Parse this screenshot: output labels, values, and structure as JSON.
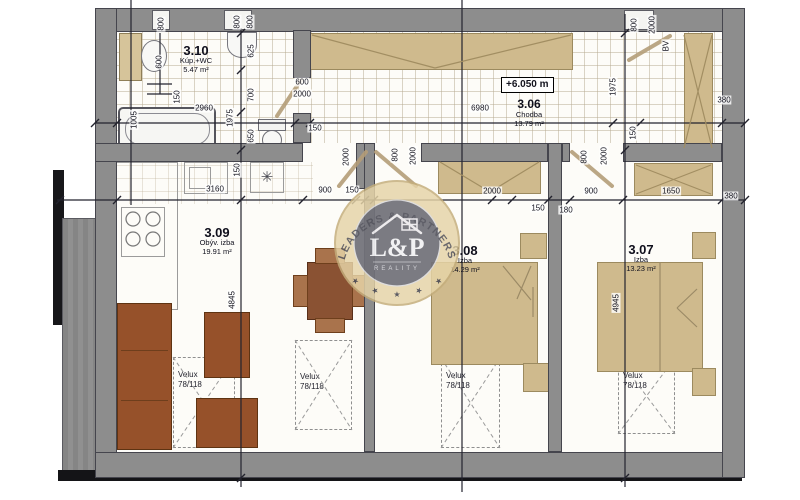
{
  "watermark": {
    "arc_text": "LEADERS & PARTNERS",
    "monogram": "L&P",
    "subtitle": "REALITY",
    "star": "★"
  },
  "level_marker": "+6.050 m",
  "rooms": [
    {
      "id": "3.10",
      "name": "Kúp.+WC",
      "area": "5.47 m²"
    },
    {
      "id": "3.06",
      "name": "Chodba",
      "area": "13.79 m²"
    },
    {
      "id": "3.09",
      "name": "Obýv. izba",
      "area": "19.91 m²"
    },
    {
      "id": "3.08",
      "name": "Izba",
      "area": "14.29 m²"
    },
    {
      "id": "3.07",
      "name": "Izba",
      "area": "13.23 m²"
    }
  ],
  "skylight": {
    "line1": "Velux",
    "line2": "78/118"
  },
  "symbols": {
    "light": "✳"
  },
  "colors": {
    "wall": "#8d8d8d",
    "furniture_tan": "#cfba8d",
    "sofa_brown": "#96512a",
    "badge_ring": "#e6d4a8"
  },
  "dimensions": [
    {
      "t": "2960",
      "x": 204,
      "y": 108,
      "r": 0
    },
    {
      "t": "150",
      "x": 315,
      "y": 128,
      "r": 0
    },
    {
      "t": "6980",
      "x": 480,
      "y": 108,
      "r": 0
    },
    {
      "t": "380",
      "x": 724,
      "y": 100,
      "r": 0
    },
    {
      "t": "3160",
      "x": 215,
      "y": 189,
      "r": 0
    },
    {
      "t": "900",
      "x": 325,
      "y": 190,
      "r": 0
    },
    {
      "t": "150",
      "x": 352,
      "y": 190,
      "r": 0
    },
    {
      "t": "2000",
      "x": 492,
      "y": 191,
      "r": 0
    },
    {
      "t": "150",
      "x": 538,
      "y": 208,
      "r": 0
    },
    {
      "t": "180",
      "x": 566,
      "y": 210,
      "r": 0
    },
    {
      "t": "900",
      "x": 591,
      "y": 191,
      "r": 0
    },
    {
      "t": "1650",
      "x": 671,
      "y": 191,
      "r": 0
    },
    {
      "t": "380",
      "x": 731,
      "y": 196,
      "r": 0
    },
    {
      "t": "600",
      "x": 302,
      "y": 82,
      "r": 0
    },
    {
      "t": "2000",
      "x": 302,
      "y": 94,
      "r": 0
    },
    {
      "t": "800",
      "x": 161,
      "y": 24,
      "r": -90
    },
    {
      "t": "800",
      "x": 237,
      "y": 22,
      "r": -90
    },
    {
      "t": "800",
      "x": 250,
      "y": 22,
      "r": -90
    },
    {
      "t": "600",
      "x": 159,
      "y": 62,
      "r": -90
    },
    {
      "t": "150",
      "x": 177,
      "y": 97,
      "r": -90
    },
    {
      "t": "1005",
      "x": 134,
      "y": 120,
      "r": -90
    },
    {
      "t": "625",
      "x": 251,
      "y": 51,
      "r": -90
    },
    {
      "t": "700",
      "x": 251,
      "y": 95,
      "r": -90
    },
    {
      "t": "650",
      "x": 251,
      "y": 136,
      "r": -90
    },
    {
      "t": "1975",
      "x": 230,
      "y": 118,
      "r": -90
    },
    {
      "t": "150",
      "x": 237,
      "y": 170,
      "r": -90
    },
    {
      "t": "2000",
      "x": 346,
      "y": 157,
      "r": -90
    },
    {
      "t": "800",
      "x": 395,
      "y": 155,
      "r": -90
    },
    {
      "t": "2000",
      "x": 413,
      "y": 156,
      "r": -90
    },
    {
      "t": "800",
      "x": 584,
      "y": 157,
      "r": -90
    },
    {
      "t": "2000",
      "x": 604,
      "y": 156,
      "r": -90
    },
    {
      "t": "1975",
      "x": 613,
      "y": 87,
      "r": -90
    },
    {
      "t": "150",
      "x": 633,
      "y": 133,
      "r": -90
    },
    {
      "t": "800",
      "x": 634,
      "y": 25,
      "r": -90
    },
    {
      "t": "2000",
      "x": 652,
      "y": 25,
      "r": -90
    },
    {
      "t": "BV",
      "x": 666,
      "y": 46,
      "r": -90
    },
    {
      "t": "4845",
      "x": 232,
      "y": 300,
      "r": -90
    },
    {
      "t": "4945",
      "x": 616,
      "y": 303,
      "r": -90
    }
  ]
}
